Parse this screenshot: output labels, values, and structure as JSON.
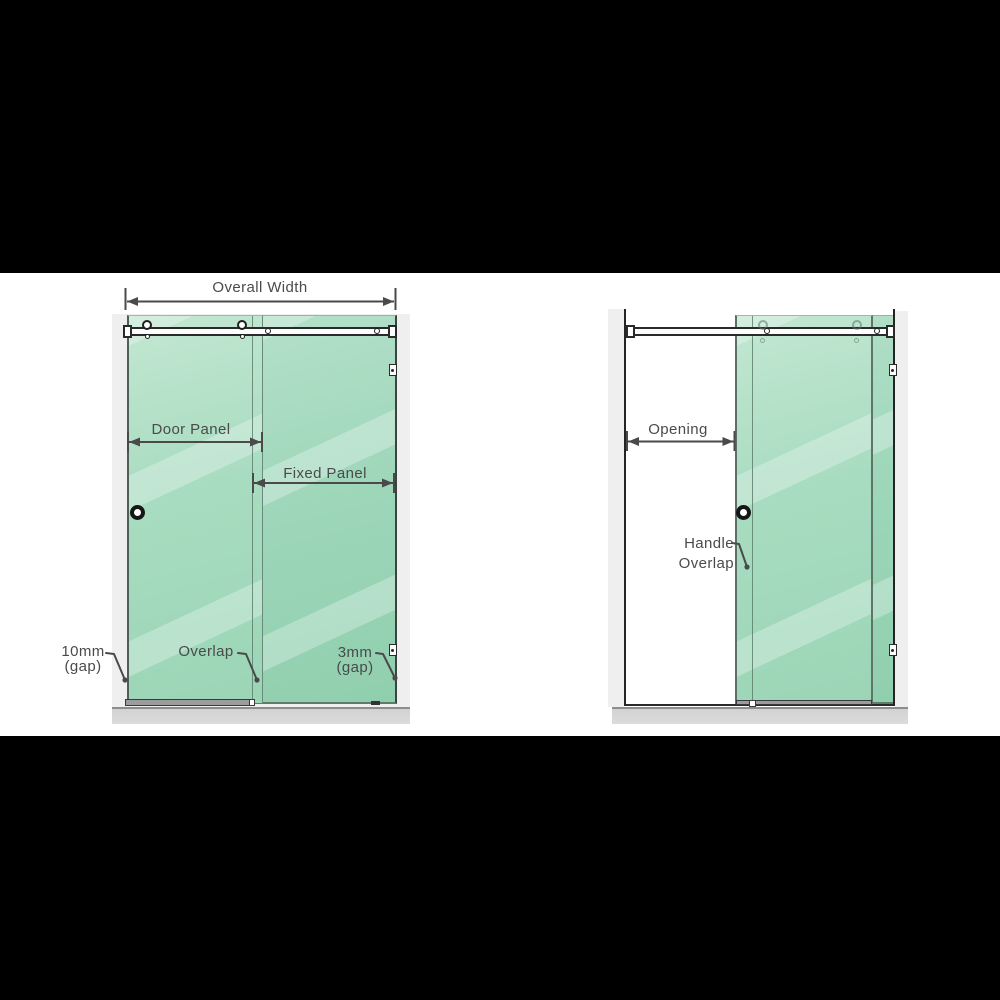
{
  "scene": {
    "type": "shower-sliding-door-dimension-diagram",
    "views": [
      "closed",
      "open"
    ]
  },
  "closed_view": {
    "overall_width_label": "Overall Width",
    "door_panel_label": "Door Panel",
    "fixed_panel_label": "Fixed Panel",
    "left_gap_value": "10mm",
    "left_gap_unit": "(gap)",
    "overlap_label": "Overlap",
    "right_gap_value": "3mm",
    "right_gap_unit": "(gap)"
  },
  "open_view": {
    "opening_label": "Opening",
    "handle_overlap_line1": "Handle",
    "handle_overlap_line2": "Overlap"
  },
  "colors": {
    "background_black": "#000000",
    "canvas_white": "#ffffff",
    "glass_green": "#a8dcc0",
    "glass_green_dark": "#90cfae",
    "glass_streak": "#cdebd9",
    "wall_gray": "#efefef",
    "floor_gray": "#d2d2d2",
    "hardware_line": "#2a2a2a",
    "annotation_gray": "#4a4a4a"
  }
}
